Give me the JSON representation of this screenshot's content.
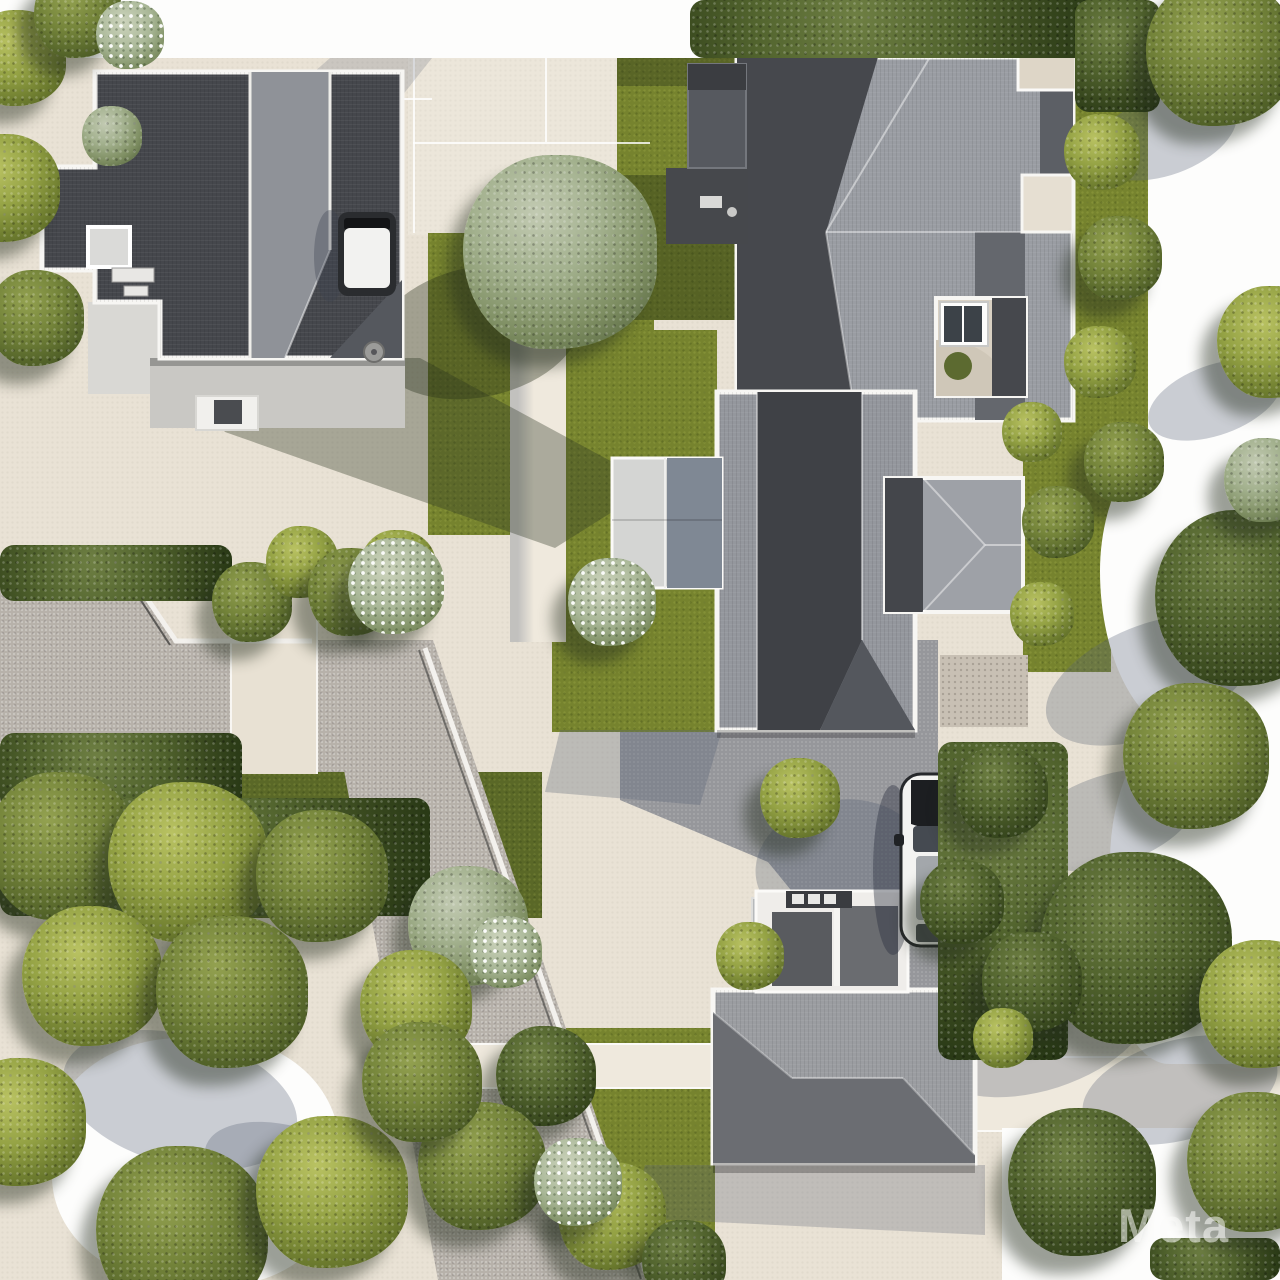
{
  "image": {
    "type": "aerial-3d-render",
    "subject": "suburban residential block, top-down view",
    "width": 1280,
    "height": 1280
  },
  "watermark": {
    "text": "Meta"
  },
  "palette": {
    "paving": "#e9e2d5",
    "plaza": "#ece6da",
    "walk": "#efe9dd",
    "street": "#b7b1aa",
    "asphalt": "#96979b",
    "paver": "#c8c0b4",
    "lawn": "#76832e",
    "hedge": "#3f4e20",
    "tree_sage": "#a3b18e",
    "tree_olive": "#94a244",
    "tree_dark": "#52642e",
    "roof_dark": "#45474c",
    "roof_light": "#9a9da3",
    "trim": "#f7f6f3",
    "wall": "#c9c8c4",
    "courtyard": "#d9d1c3",
    "car_white": "#f3f3f1",
    "car_dark": "#2a2c2f",
    "white_overexposed": "#fdfdfc",
    "shadow_cool": "rgba(85,95,115,0.30)",
    "shadow_warm": "rgba(35,45,22,0.36)"
  },
  "scene": {
    "houses": [
      {
        "name": "house-top-left",
        "roof": "dark-charcoal-cross-plan"
      },
      {
        "name": "house-top-right",
        "roof": "gray-hip-large-with-courtyard"
      },
      {
        "name": "house-middle-right",
        "roof": "gray-gable-dark-ridge"
      },
      {
        "name": "house-bottom",
        "roof": "gray-hip-two-tone"
      }
    ],
    "vehicles": [
      {
        "name": "car-by-top-left-house",
        "body": "#2a2c2f",
        "roof": "#f2f2f0"
      },
      {
        "name": "white-suv-on-driveway",
        "body": "#f3f3f1"
      }
    ],
    "foliage": [
      {
        "n": "hedge-top",
        "v": "band",
        "x": 690,
        "y": 0,
        "w": 415,
        "h": 58
      },
      {
        "n": "hedge-top-right",
        "v": "band",
        "x": 1075,
        "y": 0,
        "w": 85,
        "h": 112
      },
      {
        "n": "hedge-street-top",
        "v": "band",
        "x": 0,
        "y": 545,
        "w": 232,
        "h": 56
      },
      {
        "n": "hedge-street-bottom",
        "v": "band",
        "x": 0,
        "y": 733,
        "w": 242,
        "h": 78
      },
      {
        "n": "hedge-bottom-left",
        "v": "band",
        "x": 0,
        "y": 798,
        "w": 430,
        "h": 118
      },
      {
        "n": "hedge-driveway-east",
        "v": "band",
        "x": 938,
        "y": 742,
        "w": 130,
        "h": 318
      },
      {
        "n": "hedge-corner-bottom-right",
        "v": "band",
        "x": 1150,
        "y": 1238,
        "w": 130,
        "h": 42
      },
      {
        "n": "big-sage-tree",
        "v": "sage",
        "x": 560,
        "y": 252,
        "r": 97
      },
      {
        "n": "tree",
        "v": "dark",
        "x": 1243,
        "y": 598,
        "r": 88
      },
      {
        "n": "tree",
        "v": "olive-dark",
        "x": 1196,
        "y": 756,
        "r": 73
      },
      {
        "n": "tree",
        "v": "olive",
        "x": 18,
        "y": 58,
        "r": 48
      },
      {
        "n": "tree",
        "v": "olive-dark",
        "x": 78,
        "y": 14,
        "r": 44
      },
      {
        "n": "tree",
        "v": "olive",
        "x": 6,
        "y": 188,
        "r": 54
      },
      {
        "n": "tree",
        "v": "olive-dark",
        "x": 36,
        "y": 318,
        "r": 48
      },
      {
        "n": "tree",
        "v": "sage",
        "x": 112,
        "y": 136,
        "r": 30
      },
      {
        "n": "tree",
        "v": "olive-dark",
        "x": 1220,
        "y": 52,
        "r": 74
      },
      {
        "n": "tree",
        "v": "olive",
        "x": 1273,
        "y": 342,
        "r": 56
      },
      {
        "n": "tree",
        "v": "sage",
        "x": 1266,
        "y": 480,
        "r": 42
      },
      {
        "n": "tree",
        "v": "dark",
        "x": 1136,
        "y": 948,
        "r": 96
      },
      {
        "n": "tree",
        "v": "olive",
        "x": 1263,
        "y": 1004,
        "r": 64
      },
      {
        "n": "tree",
        "v": "dark",
        "x": 1082,
        "y": 1182,
        "r": 74
      },
      {
        "n": "tree",
        "v": "olive-dark",
        "x": 1257,
        "y": 1162,
        "r": 70
      },
      {
        "n": "tree",
        "v": "sage",
        "x": 468,
        "y": 926,
        "r": 60
      },
      {
        "n": "tree",
        "v": "olive",
        "x": 416,
        "y": 1006,
        "r": 56
      },
      {
        "n": "tree",
        "v": "dark",
        "x": 546,
        "y": 1076,
        "r": 50
      },
      {
        "n": "tree",
        "v": "olive-dark",
        "x": 482,
        "y": 1166,
        "r": 64
      },
      {
        "n": "tree",
        "v": "olive",
        "x": 612,
        "y": 1216,
        "r": 54
      },
      {
        "n": "tree",
        "v": "dark",
        "x": 684,
        "y": 1262,
        "r": 42
      },
      {
        "n": "bush",
        "v": "olive",
        "x": 800,
        "y": 798,
        "r": 40
      },
      {
        "n": "bush",
        "v": "olive",
        "x": 1102,
        "y": 152,
        "r": 38
      },
      {
        "n": "bush",
        "v": "olive-dark",
        "x": 1120,
        "y": 258,
        "r": 42
      },
      {
        "n": "bush",
        "v": "olive",
        "x": 1100,
        "y": 362,
        "r": 36
      },
      {
        "n": "bush",
        "v": "olive-dark",
        "x": 1124,
        "y": 462,
        "r": 40
      },
      {
        "n": "bush",
        "v": "olive-dark",
        "x": 252,
        "y": 602,
        "r": 40
      },
      {
        "n": "bush",
        "v": "olive",
        "x": 302,
        "y": 562,
        "r": 36
      },
      {
        "n": "bush",
        "v": "olive-dark",
        "x": 352,
        "y": 592,
        "r": 44
      },
      {
        "n": "bush",
        "v": "olive",
        "x": 398,
        "y": 568,
        "r": 38
      },
      {
        "n": "tree",
        "v": "olive-dark",
        "x": 62,
        "y": 846,
        "r": 74
      },
      {
        "n": "tree",
        "v": "olive",
        "x": 188,
        "y": 862,
        "r": 80
      },
      {
        "n": "tree",
        "v": "olive-dark",
        "x": 322,
        "y": 876,
        "r": 66
      },
      {
        "n": "tree",
        "v": "olive",
        "x": 92,
        "y": 976,
        "r": 70
      },
      {
        "n": "tree",
        "v": "olive-dark",
        "x": 232,
        "y": 992,
        "r": 76
      },
      {
        "n": "tree",
        "v": "olive",
        "x": 22,
        "y": 1122,
        "r": 64
      },
      {
        "n": "tree",
        "v": "olive-dark",
        "x": 182,
        "y": 1232,
        "r": 86
      },
      {
        "n": "tree",
        "v": "olive",
        "x": 332,
        "y": 1192,
        "r": 76
      },
      {
        "n": "tree",
        "v": "olive-dark",
        "x": 422,
        "y": 1082,
        "r": 60
      },
      {
        "n": "bush",
        "v": "dark",
        "x": 1002,
        "y": 792,
        "r": 46
      },
      {
        "n": "bush",
        "v": "dark",
        "x": 962,
        "y": 902,
        "r": 42
      },
      {
        "n": "bush",
        "v": "dark",
        "x": 1032,
        "y": 982,
        "r": 50
      },
      {
        "n": "bush",
        "v": "olive",
        "x": 750,
        "y": 956,
        "r": 34
      },
      {
        "n": "bush",
        "v": "olive",
        "x": 1032,
        "y": 432,
        "r": 30
      },
      {
        "n": "bush",
        "v": "olive-dark",
        "x": 1058,
        "y": 522,
        "r": 36
      },
      {
        "n": "bush",
        "v": "olive",
        "x": 1042,
        "y": 614,
        "r": 32
      },
      {
        "n": "bush",
        "v": "olive",
        "x": 1003,
        "y": 1038,
        "r": 30
      },
      {
        "n": "flower-bush",
        "v": "flower",
        "x": 396,
        "y": 586,
        "r": 48
      },
      {
        "n": "flower-bush",
        "v": "flower",
        "x": 612,
        "y": 602,
        "r": 44
      },
      {
        "n": "flower-bush",
        "v": "flower",
        "x": 506,
        "y": 952,
        "r": 36
      },
      {
        "n": "flower-bush",
        "v": "flower",
        "x": 578,
        "y": 1182,
        "r": 44
      },
      {
        "n": "flower-bush",
        "v": "flower",
        "x": 130,
        "y": 35,
        "r": 34
      }
    ],
    "shadow_ellipses": [
      {
        "n": "tree-shadow",
        "x": 1090,
        "y": 95,
        "w": 150,
        "h": 80,
        "rot": -20,
        "c": "cool"
      },
      {
        "n": "tree-shadow",
        "x": 1145,
        "y": 365,
        "w": 140,
        "h": 70,
        "rot": -20,
        "c": "cool"
      },
      {
        "n": "tree-shadow",
        "x": 1040,
        "y": 625,
        "w": 220,
        "h": 110,
        "rot": -22,
        "c": "cool"
      },
      {
        "n": "tree-shadow",
        "x": 1020,
        "y": 775,
        "w": 180,
        "h": 90,
        "rot": -18,
        "c": "cool"
      },
      {
        "n": "tree-shadow",
        "x": 925,
        "y": 970,
        "w": 230,
        "h": 120,
        "rot": -18,
        "c": "cool"
      },
      {
        "n": "tree-shadow",
        "x": 1080,
        "y": 1040,
        "w": 200,
        "h": 100,
        "rot": -15,
        "c": "cool"
      },
      {
        "n": "tree-shadow",
        "x": 60,
        "y": 1035,
        "w": 240,
        "h": 130,
        "rot": 15,
        "c": "cool"
      },
      {
        "n": "tree-shadow",
        "x": 200,
        "y": 1130,
        "w": 200,
        "h": 100,
        "rot": 20,
        "c": "cool"
      },
      {
        "n": "tree-shadow-on-lawn",
        "x": 373,
        "y": 267,
        "w": 210,
        "h": 130,
        "rot": -12,
        "c": "warm"
      },
      {
        "n": "driveway-shadow",
        "x": 755,
        "y": 800,
        "w": 170,
        "h": 130,
        "rot": -10,
        "c": "cool"
      }
    ]
  }
}
